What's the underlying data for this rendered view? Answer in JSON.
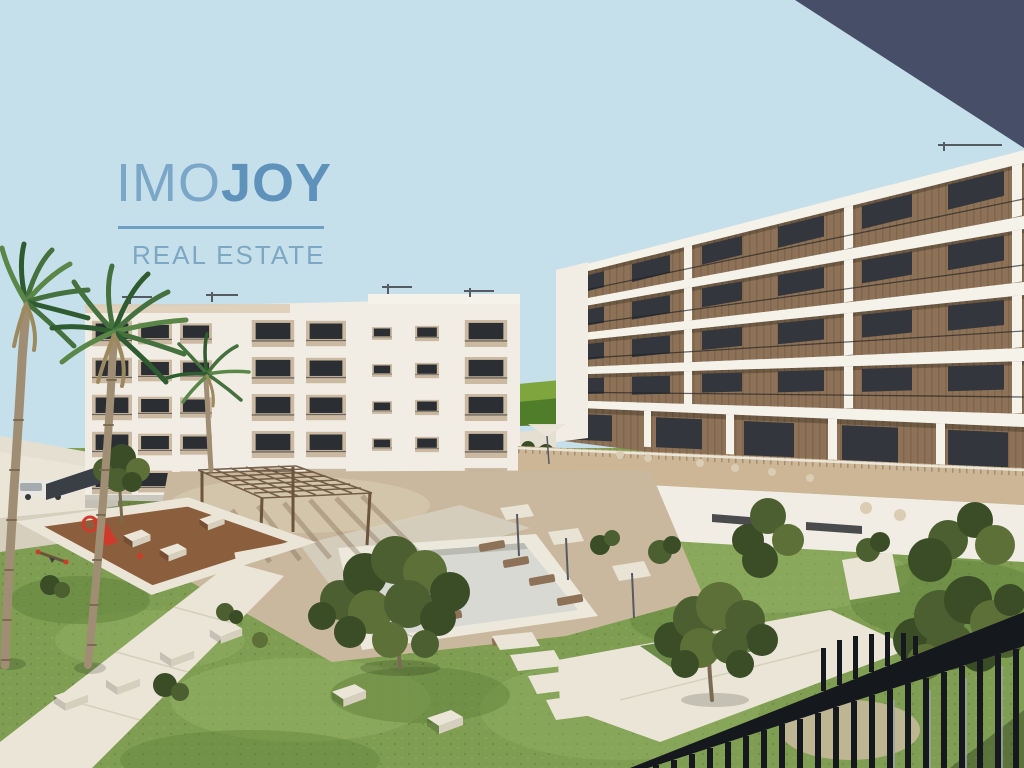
{
  "watermark": {
    "brand_prefix": "IMO",
    "brand_suffix": "JOY",
    "tagline": "REAL ESTATE"
  },
  "colors": {
    "sky": "#c6e0eb",
    "overhang": "#474f68",
    "logo_primary": "#6f9fc4",
    "logo_light": "#7aa6c8",
    "logo_bold": "#5e92bb",
    "logo_tagline": "#7ea7c4",
    "building_white": "#f1ede4",
    "slab_white": "#f5f2ea",
    "beige": "#cbb9a2",
    "beige_light": "#dccbb4",
    "wood": "#8e7257",
    "wood_dark": "#6b533c",
    "window_glass": "#33373d",
    "window_dark": "#2b2e33",
    "grass": "#7f9e52",
    "grass_light": "#95b263",
    "grass_dark": "#5e7f38",
    "deck": "#c9b89e",
    "deck_light": "#dacdb3",
    "path_white": "#eae5d7",
    "pave": "#d6cfbe",
    "pool_rim": "#ece8db",
    "pool_floor": "#d8d9d3",
    "pool_shadow": "#b9bbb3",
    "mulch": "#8b5f3d",
    "slide_red": "#cf3b2a",
    "railing": "#15181d",
    "bar_highlight": "#9aa2a8",
    "balustrade": "#cdb696",
    "distant_wall": "#e4dfd1",
    "vehicle_white": "#e9e7e1",
    "vehicle_gray": "#9aa0a6",
    "hill_light": "#7fa53f",
    "hill_dark": "#4f7d2a",
    "leaf": "#4c5f31",
    "leaf_dark": "#3a4d27",
    "leaf_light": "#5d7038",
    "trunk": "#a08e74",
    "trunk_dark": "#7c6b53",
    "palm_green": "#44713e",
    "palm_green_dark": "#2f5b31",
    "palm_green_light": "#5a8748",
    "palm_dry": "#9c8a5e",
    "antenna": "#565b63"
  },
  "scene": {
    "elements": [
      "sky",
      "roof-overhang",
      "left-apartment-building",
      "right-apartment-building",
      "podium-terrace",
      "courtyard-deck",
      "swimming-pool",
      "sun-loungers",
      "umbrellas",
      "pergola",
      "playground",
      "garden-paths",
      "bench-blocks",
      "palm-trees",
      "foreground-trees",
      "balcony-railing",
      "parked-vehicles",
      "distant-hill"
    ]
  }
}
